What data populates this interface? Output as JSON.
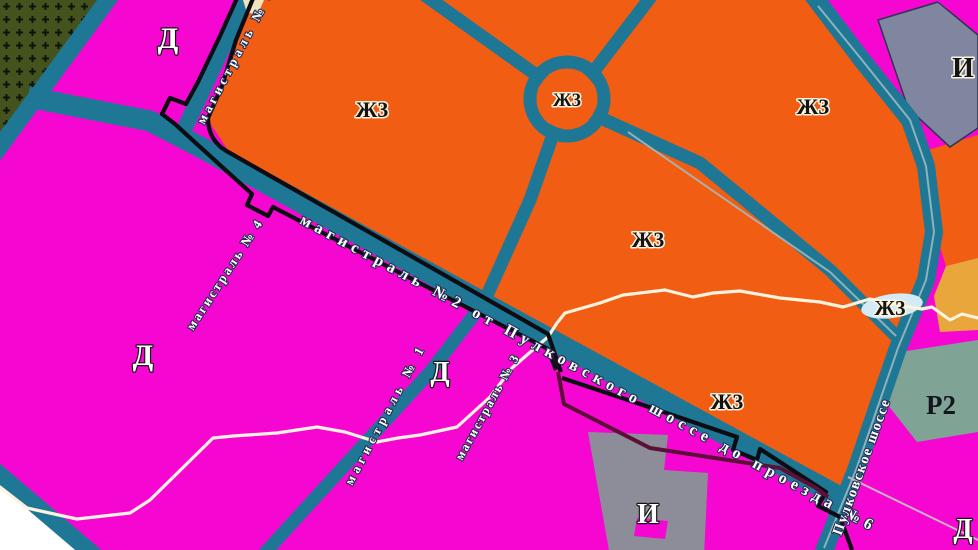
{
  "map_labels": {
    "zone_zh3": "Ж3",
    "zone_d": "Д",
    "zone_i": "И",
    "zone_r2": "Р2"
  },
  "roads": {
    "magistral_6": "магистраль № 6",
    "magistral_2": "магистраль №2 от Пулковского шоссе до проезда №6",
    "magistral_4": "магистраль № 4",
    "magistral_1": "магистраль № 1",
    "magistral_3": "магистраль № 3",
    "pulkovskoe_shosse": "Пулковское шоссе"
  },
  "colors": {
    "residential_zh3": "#f05d13",
    "business_d": "#f607d1",
    "road": "#1e7795",
    "forest": "#44531d",
    "industrial_i": "#8186a0",
    "industrial_i_south": "#8d8d99",
    "recreation_r2": "#7fa496",
    "yellow_zone": "#e9a63b",
    "boundary": "#0c0c12",
    "boundary_secondary": "#5c1038",
    "stream": "#fdf2dd",
    "pond": "#d3ebf5"
  }
}
